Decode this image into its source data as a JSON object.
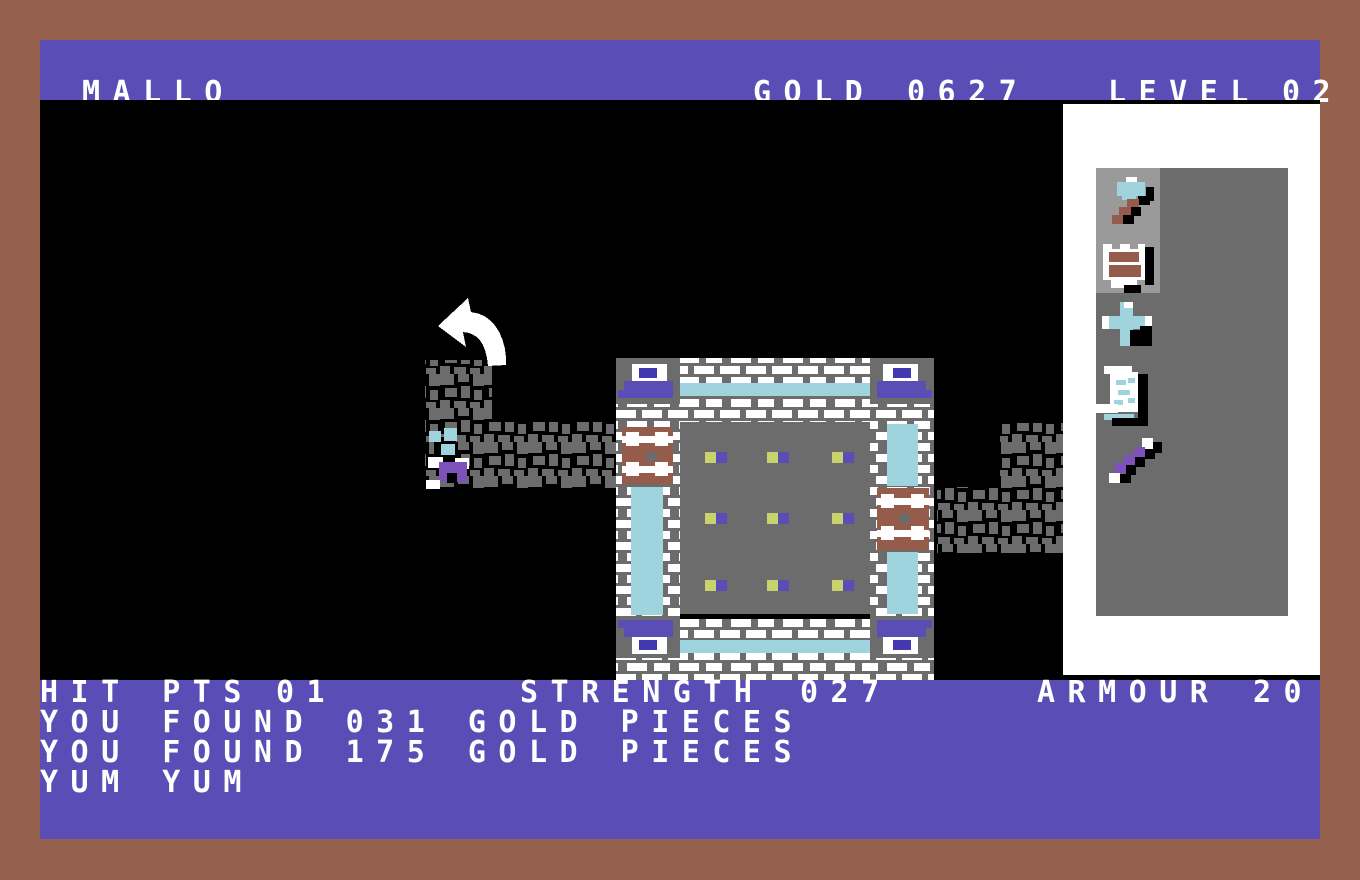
{
  "topbar": {
    "player_name": "MALLO",
    "gold_label": "GOLD",
    "gold_value": "0627",
    "level_label": "LEVEL",
    "level_value": "02",
    "commands": {
      "up": "UP",
      "down": "DOWN",
      "search": "SEARCH",
      "rest": "REST",
      "pack": "PACK"
    }
  },
  "status": {
    "hit_label": "HIT PTS",
    "hit_value": "01",
    "strength_label": "STRENGTH",
    "strength_value": "027",
    "armour_label": "ARMOUR",
    "armour_value": "20"
  },
  "messages": [
    "YOU FOUND 031 GOLD PIECES",
    "YOU FOUND 175 GOLD PIECES",
    "YUM YUM"
  ],
  "pack": {
    "items": [
      {
        "name": "mace",
        "equipped": true
      },
      {
        "name": "shield",
        "equipped": true
      },
      {
        "name": "crossbow",
        "equipped": false
      },
      {
        "name": "scroll",
        "equipped": false
      },
      {
        "name": "wand",
        "equipped": false
      }
    ]
  },
  "map": {
    "features": [
      "room",
      "left-corridor",
      "right-corridor",
      "player-character",
      "direction-arrow",
      "door-left",
      "door-right"
    ]
  },
  "colors": {
    "border_brown": "#96604F",
    "bar_purple": "#5A4DB5",
    "emblem_blue": "#4338B0",
    "map_black": "#000000",
    "stone_gray": "#6C6C6C",
    "highlight_gray": "#9A9A9A",
    "panel_white": "#FFFFFF",
    "light_blue": "#9FD4DF",
    "door_brown": "#955C4C",
    "dot_yellow": "#C8D36E",
    "player_purple": "#7E51BD",
    "text_white": "#FFFFFF"
  }
}
